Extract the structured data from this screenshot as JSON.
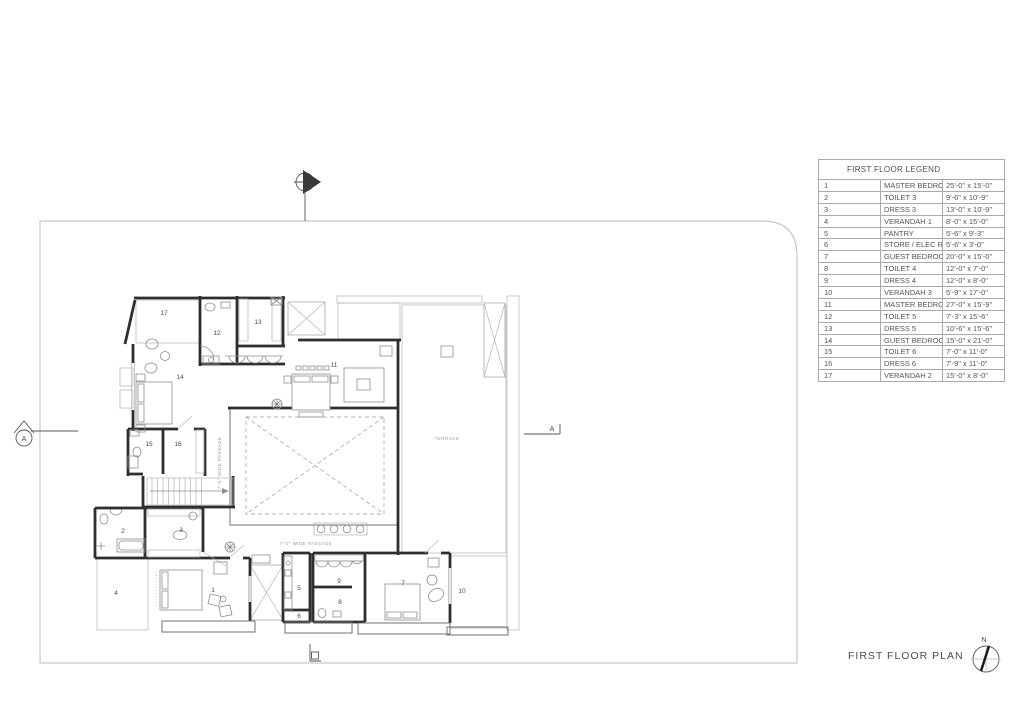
{
  "page": {
    "title": "FIRST FLOOR PLAN"
  },
  "legend": {
    "title": "FIRST FLOOR LEGEND",
    "rows": [
      {
        "no": "1",
        "name": "MASTER BEDROOM 3",
        "size": "25'-0\" x 15'-0\""
      },
      {
        "no": "2",
        "name": "TOILET 3",
        "size": "9'-6\" x 10'-9\""
      },
      {
        "no": "3",
        "name": "DRESS 3",
        "size": "13'-0\" x 10'-9\""
      },
      {
        "no": "4",
        "name": "VERANDAH 1",
        "size": "8'-0\" x 15'-0\""
      },
      {
        "no": "5",
        "name": "PANTRY",
        "size": "5'-6\" x 9'-3\""
      },
      {
        "no": "6",
        "name": "STORE / ELEC ROOM",
        "size": "5'-6\" x 3'-0\""
      },
      {
        "no": "7",
        "name": "GUEST BEDROOM 1",
        "size": "20'-0\" x 15'-0\""
      },
      {
        "no": "8",
        "name": "TOILET 4",
        "size": "12'-0\" x 7'-0\""
      },
      {
        "no": "9",
        "name": "DRESS 4",
        "size": "12'-0\" x 8'-0\""
      },
      {
        "no": "10",
        "name": "VERANDAH 3",
        "size": "5'-9\" x 17'-0\""
      },
      {
        "no": "11",
        "name": "MASTER BEDROOM 4",
        "size": "27'-0\" x 15'-9\""
      },
      {
        "no": "12",
        "name": "TOILET 5",
        "size": "7'-3\" x 15'-6\""
      },
      {
        "no": "13",
        "name": "DRESS 5",
        "size": "10'-6\" x 15'-6\""
      },
      {
        "no": "14",
        "name": "GUEST BEDROOM 2",
        "size": "15'-0\" x 21'-0\""
      },
      {
        "no": "15",
        "name": "TOILET 6",
        "size": "7'-0\" x 11'-0\""
      },
      {
        "no": "16",
        "name": "DRESS 6",
        "size": "7'-9\" x 11'-0\""
      },
      {
        "no": "17",
        "name": "VERANDAH 2",
        "size": "15'-0\" x 8'-0\""
      }
    ]
  },
  "plan": {
    "labels": {
      "passage_vertical": "7'-0\" WIDE PASSAGE",
      "passage_horizontal": "7'-0\" WIDE PASSAGE",
      "terrace": "TERRACE"
    },
    "rooms": [
      {
        "no": "1",
        "x": 213,
        "y": 592
      },
      {
        "no": "2",
        "x": 123,
        "y": 533
      },
      {
        "no": "3",
        "x": 181,
        "y": 532
      },
      {
        "no": "4",
        "x": 116,
        "y": 595
      },
      {
        "no": "5",
        "x": 299,
        "y": 590
      },
      {
        "no": "6",
        "x": 299,
        "y": 618
      },
      {
        "no": "7",
        "x": 403,
        "y": 585
      },
      {
        "no": "8",
        "x": 340,
        "y": 604
      },
      {
        "no": "9",
        "x": 339,
        "y": 583
      },
      {
        "no": "10",
        "x": 462,
        "y": 593
      },
      {
        "no": "11",
        "x": 334,
        "y": 367
      },
      {
        "no": "12",
        "x": 217,
        "y": 335
      },
      {
        "no": "13",
        "x": 258,
        "y": 324
      },
      {
        "no": "14",
        "x": 180,
        "y": 379
      },
      {
        "no": "15",
        "x": 149,
        "y": 446
      },
      {
        "no": "16",
        "x": 178,
        "y": 446
      },
      {
        "no": "17",
        "x": 164,
        "y": 315
      }
    ]
  },
  "markers": {
    "section_left": "A",
    "section_right": "A",
    "north": "N"
  }
}
